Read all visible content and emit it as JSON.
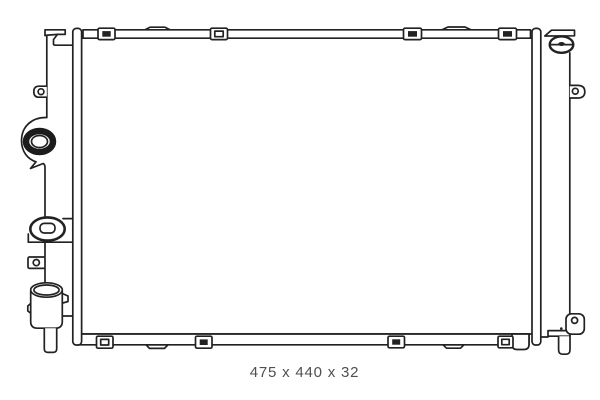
{
  "drawing": {
    "name": "radiator-technical-line-drawing",
    "caption": "475 x 440 x 32"
  },
  "colors": {
    "line": "#222222",
    "caption_text": "#4f4f4f",
    "background": "#ffffff"
  }
}
